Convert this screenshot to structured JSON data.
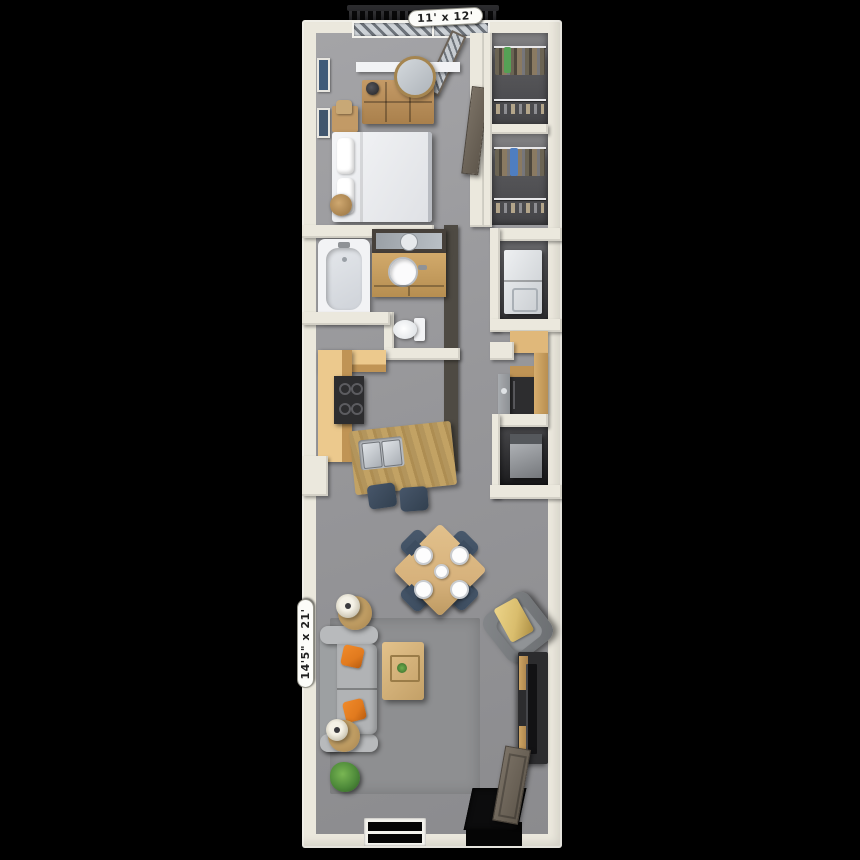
{
  "scene": {
    "type": "3d-floor-plan-render",
    "background": "#000000"
  },
  "labels": {
    "bedroom_dimensions": "11' x 12'",
    "living_room_dimensions": "14'5\" x 21'"
  },
  "rooms": {
    "balcony": {
      "features": [
        "railing"
      ]
    },
    "bedroom": {
      "furniture": [
        "bed",
        "pillows",
        "dresser",
        "round-mirror",
        "dresser-lamp",
        "nightstand",
        "bag",
        "basket",
        "wall-art",
        "window",
        "glass-balcony-door",
        "room-door"
      ]
    },
    "closets": {
      "count": 2,
      "contents": [
        "clothes-rod",
        "hanging-clothes",
        "shoe-shelf"
      ]
    },
    "bathroom": {
      "fixtures": [
        "bathtub",
        "vanity-mirror",
        "vanity-sink",
        "toilet"
      ]
    },
    "laundry_closet": {
      "appliances": [
        "stacked-washer-dryer"
      ]
    },
    "kitchen": {
      "features": [
        "l-shaped-counter",
        "range",
        "island-with-double-sink",
        "bar-stools",
        "refrigerator",
        "tall-cabinet",
        "side-sink-counter",
        "water-heater-closet"
      ]
    },
    "living_room": {
      "furniture": [
        "area-rug",
        "sofa",
        "orange-throw-pillows",
        "side-tables-with-lamps",
        "coffee-table",
        "dining-table",
        "dining-chairs",
        "place-settings",
        "armchair-with-gold-throw",
        "tv-console",
        "tv",
        "potted-plant",
        "entry-door",
        "door-mat",
        "window"
      ]
    }
  },
  "palette": {
    "bg": "#000000",
    "wall": "#ebe8dd",
    "wall_dark": "#4e4a43",
    "floor_light": "#a4a4a7",
    "floor_dark": "#8b8b8e",
    "rug": "#8e8f91",
    "closet_floor": "#454548",
    "counter": "#e0b87a",
    "counter_face": "#c09455",
    "island": "#b3955c",
    "wood": "#d7b27c",
    "sofa": "#b1b3b5",
    "sofa_dark": "#9da0a2",
    "pillow": "#e17a1e",
    "navy": "#3d4d60",
    "appliance": "#2d2d2f",
    "fixture": "#f2f3f5",
    "metal": "#9fa2a6",
    "door": "#7a7165",
    "glass": "#c7ccd1",
    "stripe": "#6d737a",
    "railing": "#2e2e31",
    "gold": "#d9bd6d",
    "plant": "#4e8a3a",
    "label_bg": "#fcfcf9",
    "label_text": "#1f1f1f"
  }
}
